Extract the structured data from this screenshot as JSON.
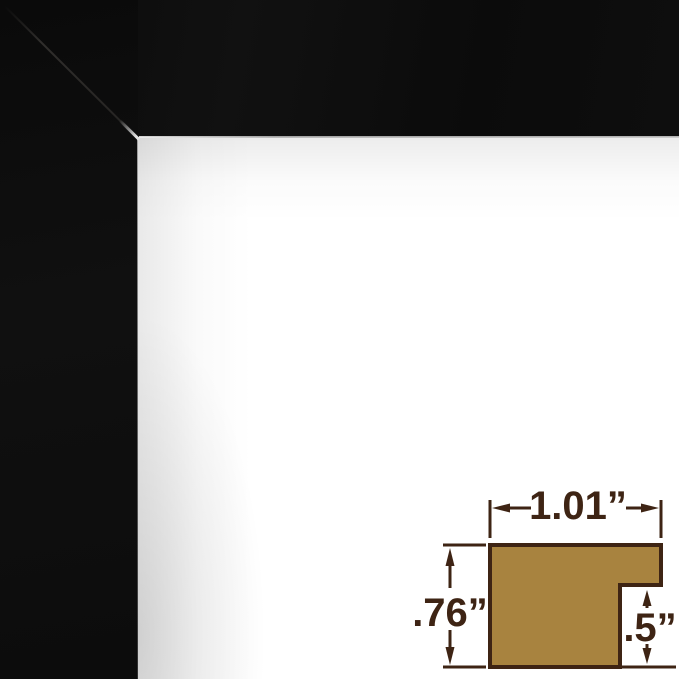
{
  "image": {
    "frame_color": "#0d0d0d",
    "backing_color": "#ffffff"
  },
  "diagram": {
    "profile_fill": "#a8833f",
    "line_color": "#3e2414",
    "dimensions": {
      "width_label": "1.01”",
      "height_label": ".76”",
      "depth_label": ".5”"
    }
  }
}
